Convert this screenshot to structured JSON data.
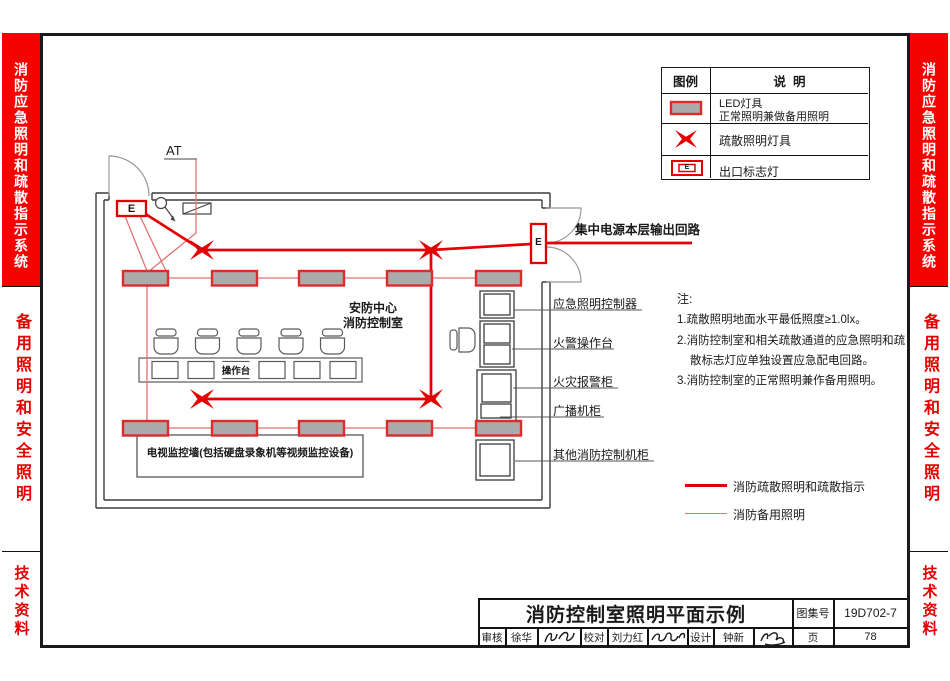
{
  "sidebar": {
    "section1": "消防应急照明和疏散指示系统",
    "section2": "备用照明和安全照明",
    "section3": "技术资料"
  },
  "legend_table": {
    "header_symbol": "图例",
    "header_desc": "说  明",
    "row1_line1": "LED灯具",
    "row1_line2": "正常照明兼做备用照明",
    "row2_desc": "疏散照明灯具",
    "row3_desc": "出口标志灯"
  },
  "plan": {
    "panel_label": "AT",
    "exit_letter": "E",
    "room_name_line1": "安防中心",
    "room_name_line2": "消防控制室",
    "console_label": "操作台",
    "tv_wall_label": "电视监控墙(包括硬盘录象机等视频监控设备)",
    "output_circuit_label": "集中电源本层输出回路",
    "cabinet_labels": [
      "应急照明控制器",
      "火警操作台",
      "火灾报警柜",
      "广播机柜",
      "其他消防控制机柜"
    ]
  },
  "notes": {
    "title": "注:",
    "line1": "1.疏散照明地面水平最低照度≥1.0lx。",
    "line2a": "2.消防控制室和相关疏散通道的应急照明和疏",
    "line2b": "散标志灯应单独设置应急配电回路。",
    "line3": "3.消防控制室的正常照明兼作备用照明。"
  },
  "line_legend": {
    "evac_label": "消防疏散照明和疏散指示",
    "backup_label": "消防备用照明"
  },
  "title_block": {
    "title": "消防控制室照明平面示例",
    "atlas_label": "图集号",
    "atlas_no": "19D702-7",
    "page_label": "页",
    "page_no": "78",
    "reviewer_label": "审核",
    "reviewer_name": "徐华",
    "proofreader_label": "校对",
    "proofreader_name": "刘力红",
    "designer_label": "设计",
    "designer_name": "钟新"
  },
  "colors": {
    "sidebar_red": "#f40300",
    "drawing_red": "#e40000",
    "backup_line_red": "#e17272",
    "led_fill_gray": "#ababab"
  }
}
